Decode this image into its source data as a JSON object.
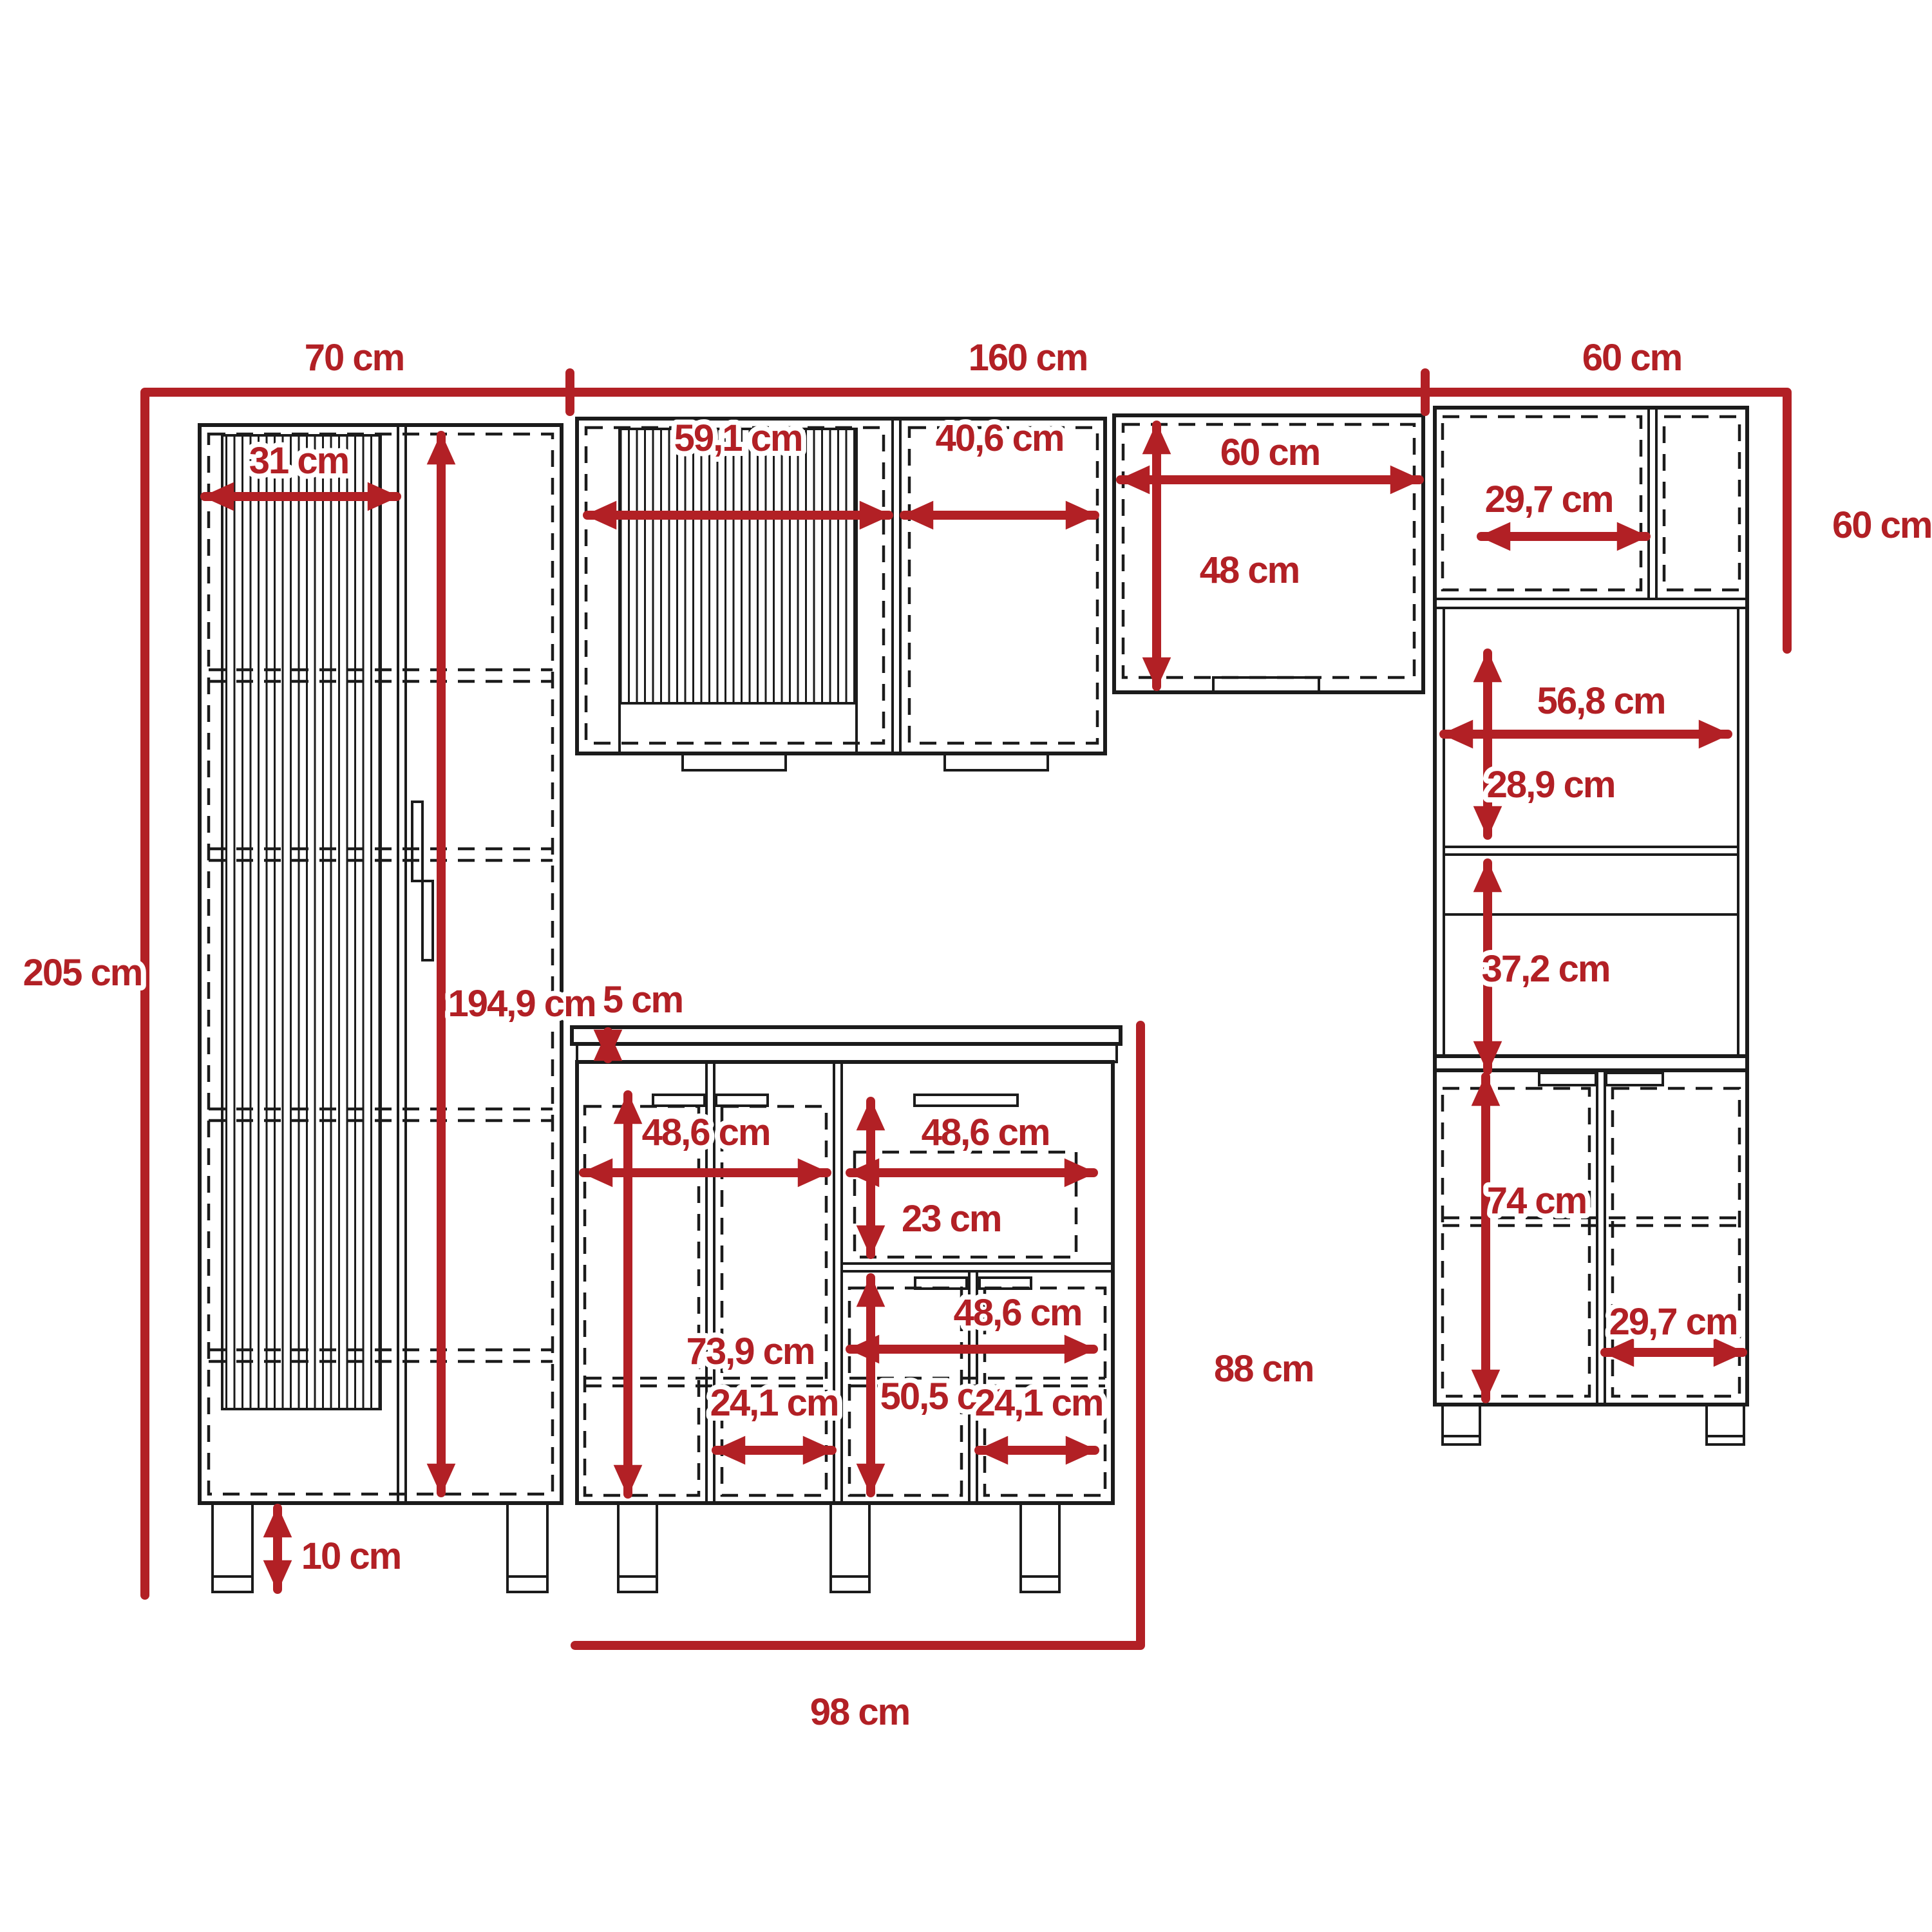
{
  "diagram": {
    "title": "kitchen-cabinet-set-dimension-drawing",
    "unit": "cm",
    "colors": {
      "dimension_red": "#b22025",
      "line_black": "#1b1b1b",
      "background": "#ffffff"
    },
    "dims": {
      "top_left_width": "70 cm",
      "top_middle_width": "160 cm",
      "top_right_width": "60 cm",
      "left_total_height": "205 cm",
      "tall_door_width": "31 cm",
      "tall_interior_height": "194,9 cm",
      "leg_height": "10 cm",
      "wall_door1_width": "59,1 cm",
      "wall_door2_width": "40,6 cm",
      "wall_cab3_width": "60 cm",
      "wall_cab3_height": "48 cm",
      "right_upper_door_width": "29,7 cm",
      "right_upper_height": "60 cm",
      "right_shelf_width": "56,8 cm",
      "right_shelf1_height": "28,9 cm",
      "right_shelf2_height": "37,2 cm",
      "right_lower_height": "74 cm",
      "right_lower_door_width": "29,7 cm",
      "countertop_thickness": "5 cm",
      "base_left_width": "48,6 cm",
      "base_drawer_width": "48,6 cm",
      "base_drawer_height": "23 cm",
      "base_left_interior_height": "73,9 cm",
      "base_right_lower_width": "48,6 cm",
      "base_right_lower_height": "50,5 cm",
      "base_left_door_width": "24,1 cm",
      "base_right_door_width": "24,1 cm",
      "base_total_height": "88 cm",
      "base_total_width": "98 cm"
    }
  }
}
